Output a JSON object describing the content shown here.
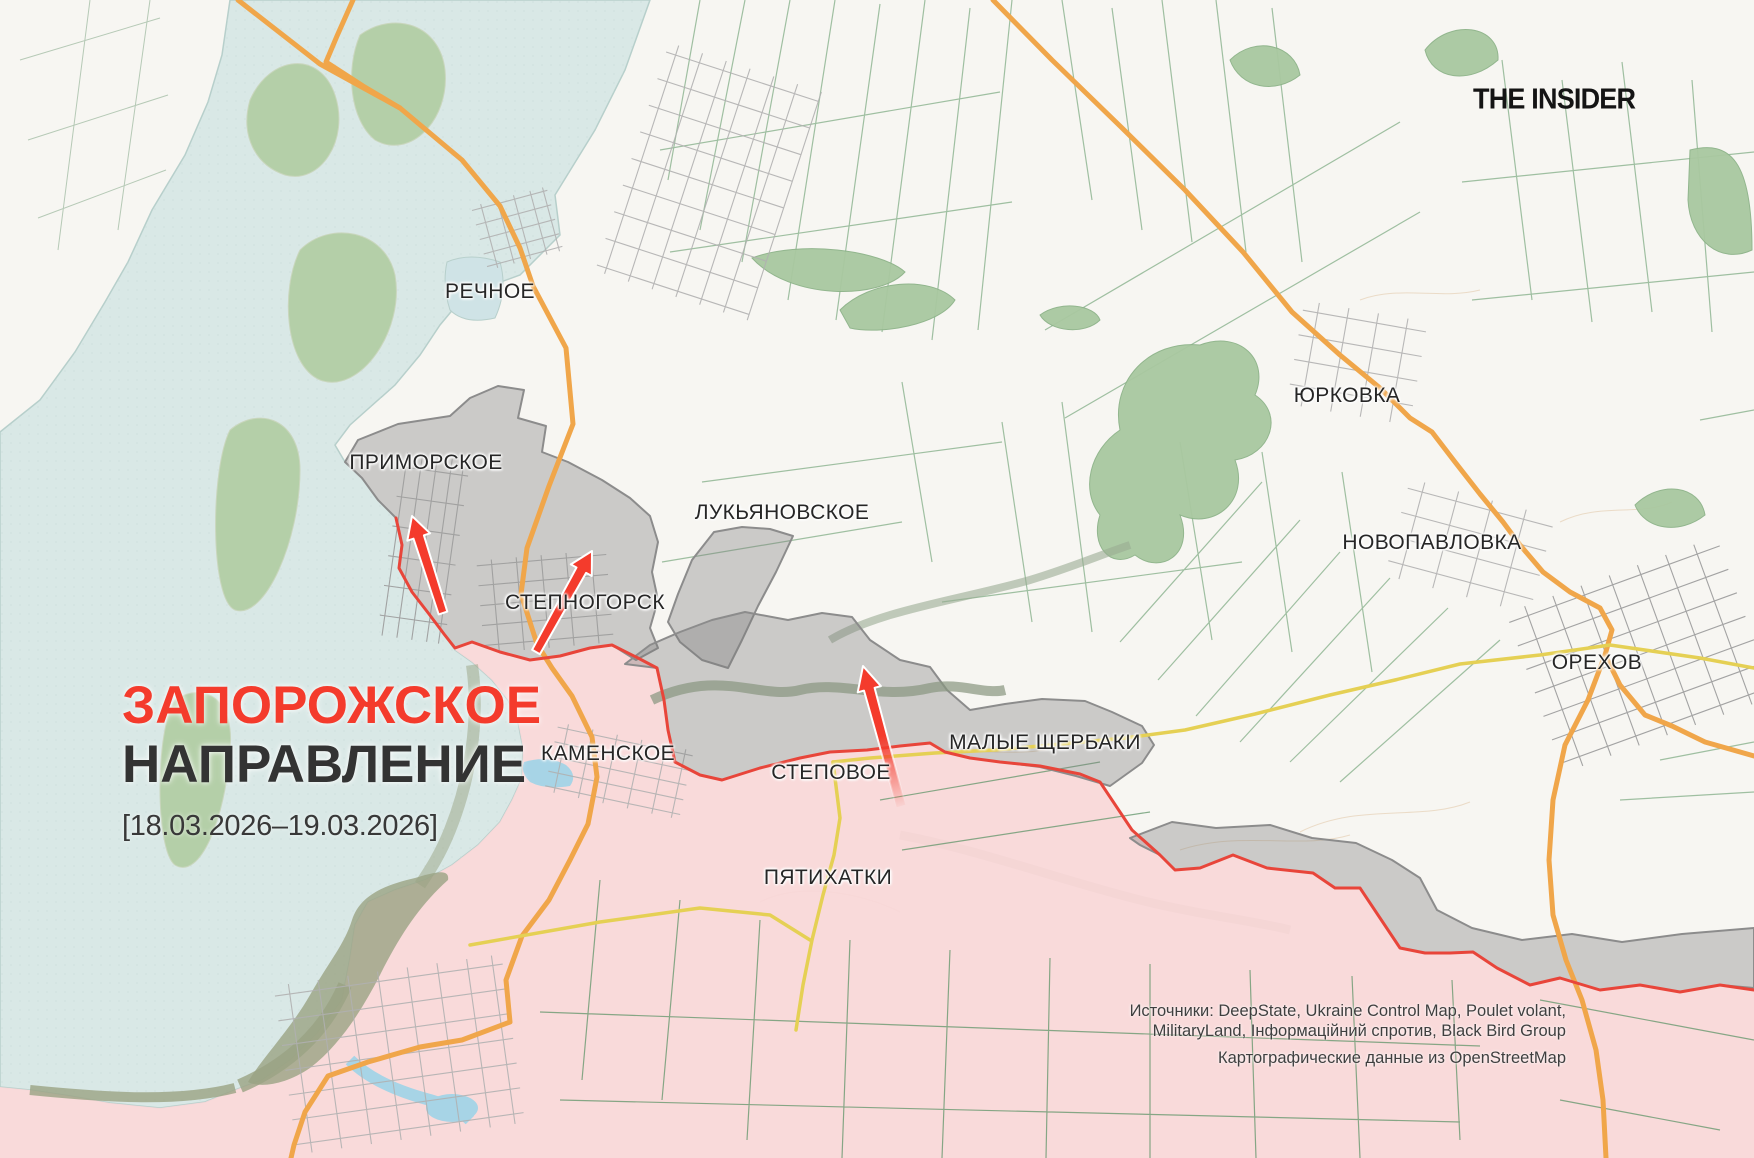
{
  "branding": {
    "logo_text": "THE INSIDER"
  },
  "title_block": {
    "line1": "ЗАПОРОЖСКОЕ",
    "line2": "НАПРАВЛЕНИЕ",
    "date_range": "[18.03.2026–19.03.2026]"
  },
  "attribution": {
    "sources_line1": "Источники: DeepState, Ukraine Control Map, Poulet volant,",
    "sources_line2": "MilitaryLand, Інформаційний спротив, Black Bird Group",
    "map_credit": "Картографические данные из OpenStreetMap"
  },
  "map": {
    "settlements": [
      {
        "name": "РЕЧНОЕ",
        "x": 490,
        "y": 292
      },
      {
        "name": "ПРИМОРСКОЕ",
        "x": 426,
        "y": 463
      },
      {
        "name": "ЛУКЬЯНОВСКОЕ",
        "x": 782,
        "y": 513
      },
      {
        "name": "СТЕПНОГОРСК",
        "x": 585,
        "y": 603
      },
      {
        "name": "КАМЕНСКОЕ",
        "x": 608,
        "y": 754
      },
      {
        "name": "СТЕПОВОЕ",
        "x": 831,
        "y": 773
      },
      {
        "name": "МАЛЫЕ ЩЕРБАКИ",
        "x": 1045,
        "y": 743
      },
      {
        "name": "ПЯТИХАТКИ",
        "x": 828,
        "y": 878
      },
      {
        "name": "ЮРКОВКА",
        "x": 1347,
        "y": 396
      },
      {
        "name": "НОВОПАВЛОВКА",
        "x": 1432,
        "y": 543
      },
      {
        "name": "ОРЕХОВ",
        "x": 1597,
        "y": 663
      }
    ],
    "colors": {
      "accent_red": "#f43b2c",
      "attack_arrow": "#f43b2c",
      "occupied_fill": "#f8d7d8",
      "occupied_border": "#e8453a",
      "contested_fill": "#7d7d7d",
      "contested_border": "#8c8c8c",
      "water": "#d9e8e6",
      "road_orange": "#f0a64a",
      "road_yellow": "#e5d054"
    },
    "attack_arrows": [
      {
        "name": "primorske-attack",
        "from_x": 443,
        "from_y": 613,
        "to_x": 412,
        "to_y": 516
      },
      {
        "name": "stepnohirsk-attack",
        "from_x": 536,
        "from_y": 652,
        "to_x": 592,
        "to_y": 551
      },
      {
        "name": "stepove-attack",
        "from_x": 901,
        "from_y": 806,
        "to_x": 863,
        "to_y": 666
      }
    ]
  }
}
